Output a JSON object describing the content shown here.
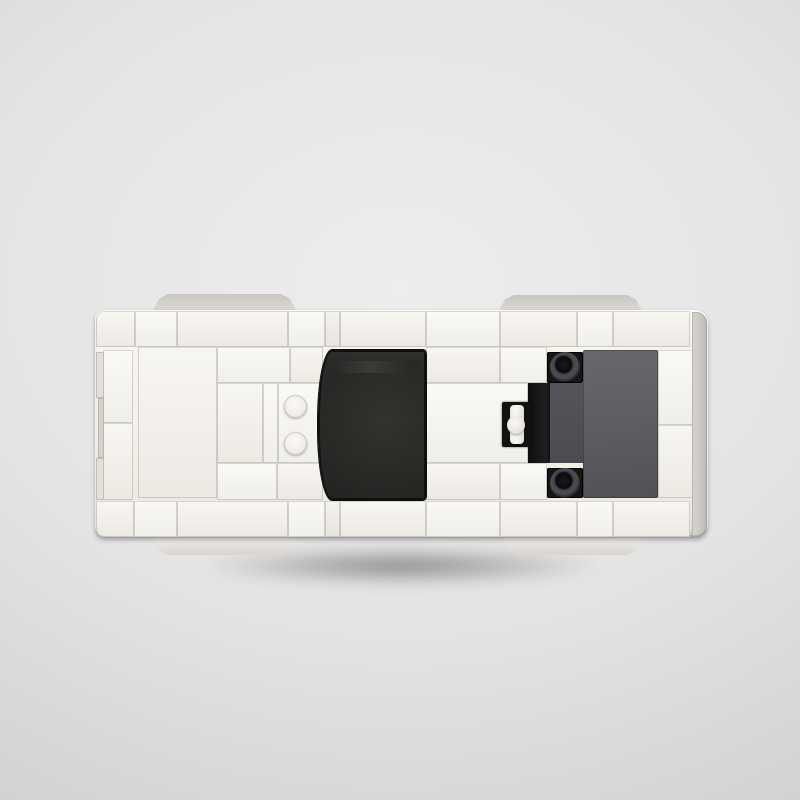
{
  "scene": {
    "title": "Top-down view of a white brick-built toy sports car on a gray studio background",
    "background_center": "#ededed",
    "background_edge": "#bdbdbd"
  },
  "car": {
    "label": "white-brick-car-top-view",
    "origin": {
      "x": 95,
      "y": 310
    },
    "size": {
      "w": 613,
      "h": 228
    },
    "palette": {
      "white1": "#f8f6f1",
      "white2": "#f4f1eb",
      "white3": "#efece5",
      "glass": "#262624",
      "gray_panel": "#5c5e61",
      "gray_mid": "#53555a",
      "black": "#161616",
      "wheel_top": "#c9c6c2",
      "wheel_bottom": "#f2f0ec",
      "edge_strip": "#d7d4d0"
    },
    "elements": [
      {
        "name": "wheel-top-left",
        "kind": "wheelT",
        "x": 57,
        "y": -16,
        "w": 145,
        "h": 18
      },
      {
        "name": "wheel-top-right",
        "kind": "wheelT",
        "x": 403,
        "y": -15,
        "w": 145,
        "h": 17
      },
      {
        "name": "wheel-bottom-left",
        "kind": "wheelB",
        "x": 57,
        "y": 226,
        "w": 145,
        "h": 19
      },
      {
        "name": "wheel-bottom-right",
        "kind": "wheelB",
        "x": 407,
        "y": 226,
        "w": 141,
        "h": 19
      },
      {
        "name": "car-body",
        "kind": "body",
        "x": 0,
        "y": 0,
        "w": 613,
        "h": 228
      },
      {
        "name": "brick-top-row-1",
        "kind": "w2",
        "x": 1,
        "y": 1,
        "w": 39,
        "h": 36,
        "r": "8px 0 0 0"
      },
      {
        "name": "brick-top-row-2",
        "kind": "w1",
        "x": 40,
        "y": 1,
        "w": 42,
        "h": 36
      },
      {
        "name": "brick-top-row-3",
        "kind": "w2",
        "x": 82,
        "y": 1,
        "w": 111,
        "h": 36
      },
      {
        "name": "brick-top-row-4",
        "kind": "w1",
        "x": 193,
        "y": 1,
        "w": 37,
        "h": 36
      },
      {
        "name": "brick-top-row-5",
        "kind": "w3",
        "x": 230,
        "y": 1,
        "w": 15,
        "h": 36
      },
      {
        "name": "brick-top-row-6",
        "kind": "w2",
        "x": 245,
        "y": 1,
        "w": 86,
        "h": 36
      },
      {
        "name": "brick-top-row-7",
        "kind": "w1",
        "x": 331,
        "y": 1,
        "w": 74,
        "h": 36
      },
      {
        "name": "brick-top-row-8",
        "kind": "w2",
        "x": 405,
        "y": 1,
        "w": 77,
        "h": 36
      },
      {
        "name": "brick-top-row-9",
        "kind": "w1",
        "x": 482,
        "y": 1,
        "w": 36,
        "h": 36
      },
      {
        "name": "brick-top-row-10",
        "kind": "w2",
        "x": 518,
        "y": 1,
        "w": 77,
        "h": 36
      },
      {
        "name": "brick-bottom-row-1",
        "kind": "w2",
        "x": 1,
        "y": 191,
        "w": 38,
        "h": 36,
        "r": "0 0 0 8px"
      },
      {
        "name": "brick-bottom-row-2",
        "kind": "w1",
        "x": 39,
        "y": 191,
        "w": 43,
        "h": 36
      },
      {
        "name": "brick-bottom-row-3",
        "kind": "w2",
        "x": 82,
        "y": 191,
        "w": 111,
        "h": 36
      },
      {
        "name": "brick-bottom-row-4",
        "kind": "w1",
        "x": 193,
        "y": 191,
        "w": 37,
        "h": 36
      },
      {
        "name": "brick-bottom-row-5",
        "kind": "w3",
        "x": 230,
        "y": 191,
        "w": 15,
        "h": 36
      },
      {
        "name": "brick-bottom-row-6",
        "kind": "w2",
        "x": 245,
        "y": 191,
        "w": 86,
        "h": 36
      },
      {
        "name": "brick-bottom-row-7",
        "kind": "w1",
        "x": 331,
        "y": 191,
        "w": 74,
        "h": 36
      },
      {
        "name": "brick-bottom-row-8",
        "kind": "w2",
        "x": 405,
        "y": 191,
        "w": 77,
        "h": 36
      },
      {
        "name": "brick-bottom-row-9",
        "kind": "w1",
        "x": 482,
        "y": 191,
        "w": 36,
        "h": 36
      },
      {
        "name": "brick-bottom-row-10",
        "kind": "w2",
        "x": 518,
        "y": 191,
        "w": 77,
        "h": 36
      },
      {
        "name": "brick-left-upper",
        "kind": "w1",
        "x": 8,
        "y": 40,
        "w": 30,
        "h": 73
      },
      {
        "name": "brick-left-lower",
        "kind": "w2",
        "x": 8,
        "y": 113,
        "w": 30,
        "h": 77
      },
      {
        "name": "bumper-tab-1",
        "kind": "tab",
        "x": 1,
        "y": 42,
        "w": 8,
        "h": 46
      },
      {
        "name": "bumper-tab-2",
        "kind": "tab2",
        "x": 3,
        "y": 88,
        "w": 6,
        "h": 60
      },
      {
        "name": "bumper-tab-3",
        "kind": "tab",
        "x": 1,
        "y": 148,
        "w": 8,
        "h": 42
      },
      {
        "name": "panel-front",
        "kind": "w2",
        "x": 43,
        "y": 37,
        "w": 79,
        "h": 151
      },
      {
        "name": "brick-mid-1",
        "kind": "w1",
        "x": 122,
        "y": 37,
        "w": 73,
        "h": 36
      },
      {
        "name": "brick-mid-2",
        "kind": "w2",
        "x": 195,
        "y": 37,
        "w": 33,
        "h": 36
      },
      {
        "name": "panel-cockpit-left",
        "kind": "w2",
        "x": 122,
        "y": 73,
        "w": 46,
        "h": 80
      },
      {
        "name": "strip-cockpit",
        "kind": "w1",
        "x": 168,
        "y": 73,
        "w": 15,
        "h": 80
      },
      {
        "name": "plate-studs",
        "kind": "w1",
        "x": 183,
        "y": 73,
        "w": 45,
        "h": 80
      },
      {
        "name": "brick-mid-3",
        "kind": "w1",
        "x": 122,
        "y": 153,
        "w": 60,
        "h": 37
      },
      {
        "name": "brick-mid-4",
        "kind": "w2",
        "x": 182,
        "y": 153,
        "w": 46,
        "h": 37
      },
      {
        "name": "stud-1",
        "kind": "stud",
        "x": 189,
        "y": 85,
        "w": 23,
        "h": 23
      },
      {
        "name": "stud-2",
        "kind": "stud",
        "x": 189,
        "y": 122,
        "w": 23,
        "h": 23
      },
      {
        "name": "brick-roof-1",
        "kind": "w2",
        "x": 331,
        "y": 37,
        "w": 74,
        "h": 36
      },
      {
        "name": "brick-roof-2",
        "kind": "w1",
        "x": 405,
        "y": 37,
        "w": 47,
        "h": 36
      },
      {
        "name": "panel-roof",
        "kind": "w1",
        "x": 331,
        "y": 73,
        "w": 102,
        "h": 80
      },
      {
        "name": "brick-roof-3",
        "kind": "w2",
        "x": 331,
        "y": 153,
        "w": 74,
        "h": 37
      },
      {
        "name": "brick-roof-4",
        "kind": "w1",
        "x": 405,
        "y": 153,
        "w": 47,
        "h": 37
      },
      {
        "name": "windshield-glass",
        "kind": "glass",
        "x": 223,
        "y": 40,
        "w": 108,
        "h": 150
      },
      {
        "name": "intake-strip",
        "kind": "blkstrip",
        "x": 433,
        "y": 73,
        "w": 19,
        "h": 80
      },
      {
        "name": "console-bracket",
        "kind": "bracket",
        "x": 407,
        "y": 92,
        "w": 30,
        "h": 45
      },
      {
        "name": "console-bar",
        "kind": "bar",
        "x": 415,
        "y": 95,
        "w": 14,
        "h": 39
      },
      {
        "name": "console-knob",
        "kind": "knob",
        "x": 412,
        "y": 106,
        "w": 18,
        "h": 18
      },
      {
        "name": "engine-mid",
        "kind": "gmid",
        "x": 452,
        "y": 73,
        "w": 36,
        "h": 80
      },
      {
        "name": "pin-plate-top",
        "kind": "ringsq",
        "x": 452,
        "y": 42,
        "w": 36,
        "h": 31
      },
      {
        "name": "pin-plate-bottom",
        "kind": "ringsq",
        "x": 452,
        "y": 158,
        "w": 36,
        "h": 30
      },
      {
        "name": "pin-ring-top",
        "kind": "ring",
        "x": 455,
        "y": 42,
        "w": 30,
        "h": 30
      },
      {
        "name": "pin-ring-bottom",
        "kind": "ring",
        "x": 455,
        "y": 158,
        "w": 30,
        "h": 30
      },
      {
        "name": "engine-cover",
        "kind": "gpanel",
        "x": 488,
        "y": 40,
        "w": 75,
        "h": 148
      },
      {
        "name": "brick-rear-upper",
        "kind": "w1",
        "x": 563,
        "y": 40,
        "w": 37,
        "h": 75
      },
      {
        "name": "brick-rear-lower",
        "kind": "w2",
        "x": 563,
        "y": 115,
        "w": 37,
        "h": 73
      },
      {
        "name": "rear-bumper-strip",
        "kind": "estrip",
        "x": 597,
        "y": 2,
        "w": 15,
        "h": 224
      }
    ]
  }
}
